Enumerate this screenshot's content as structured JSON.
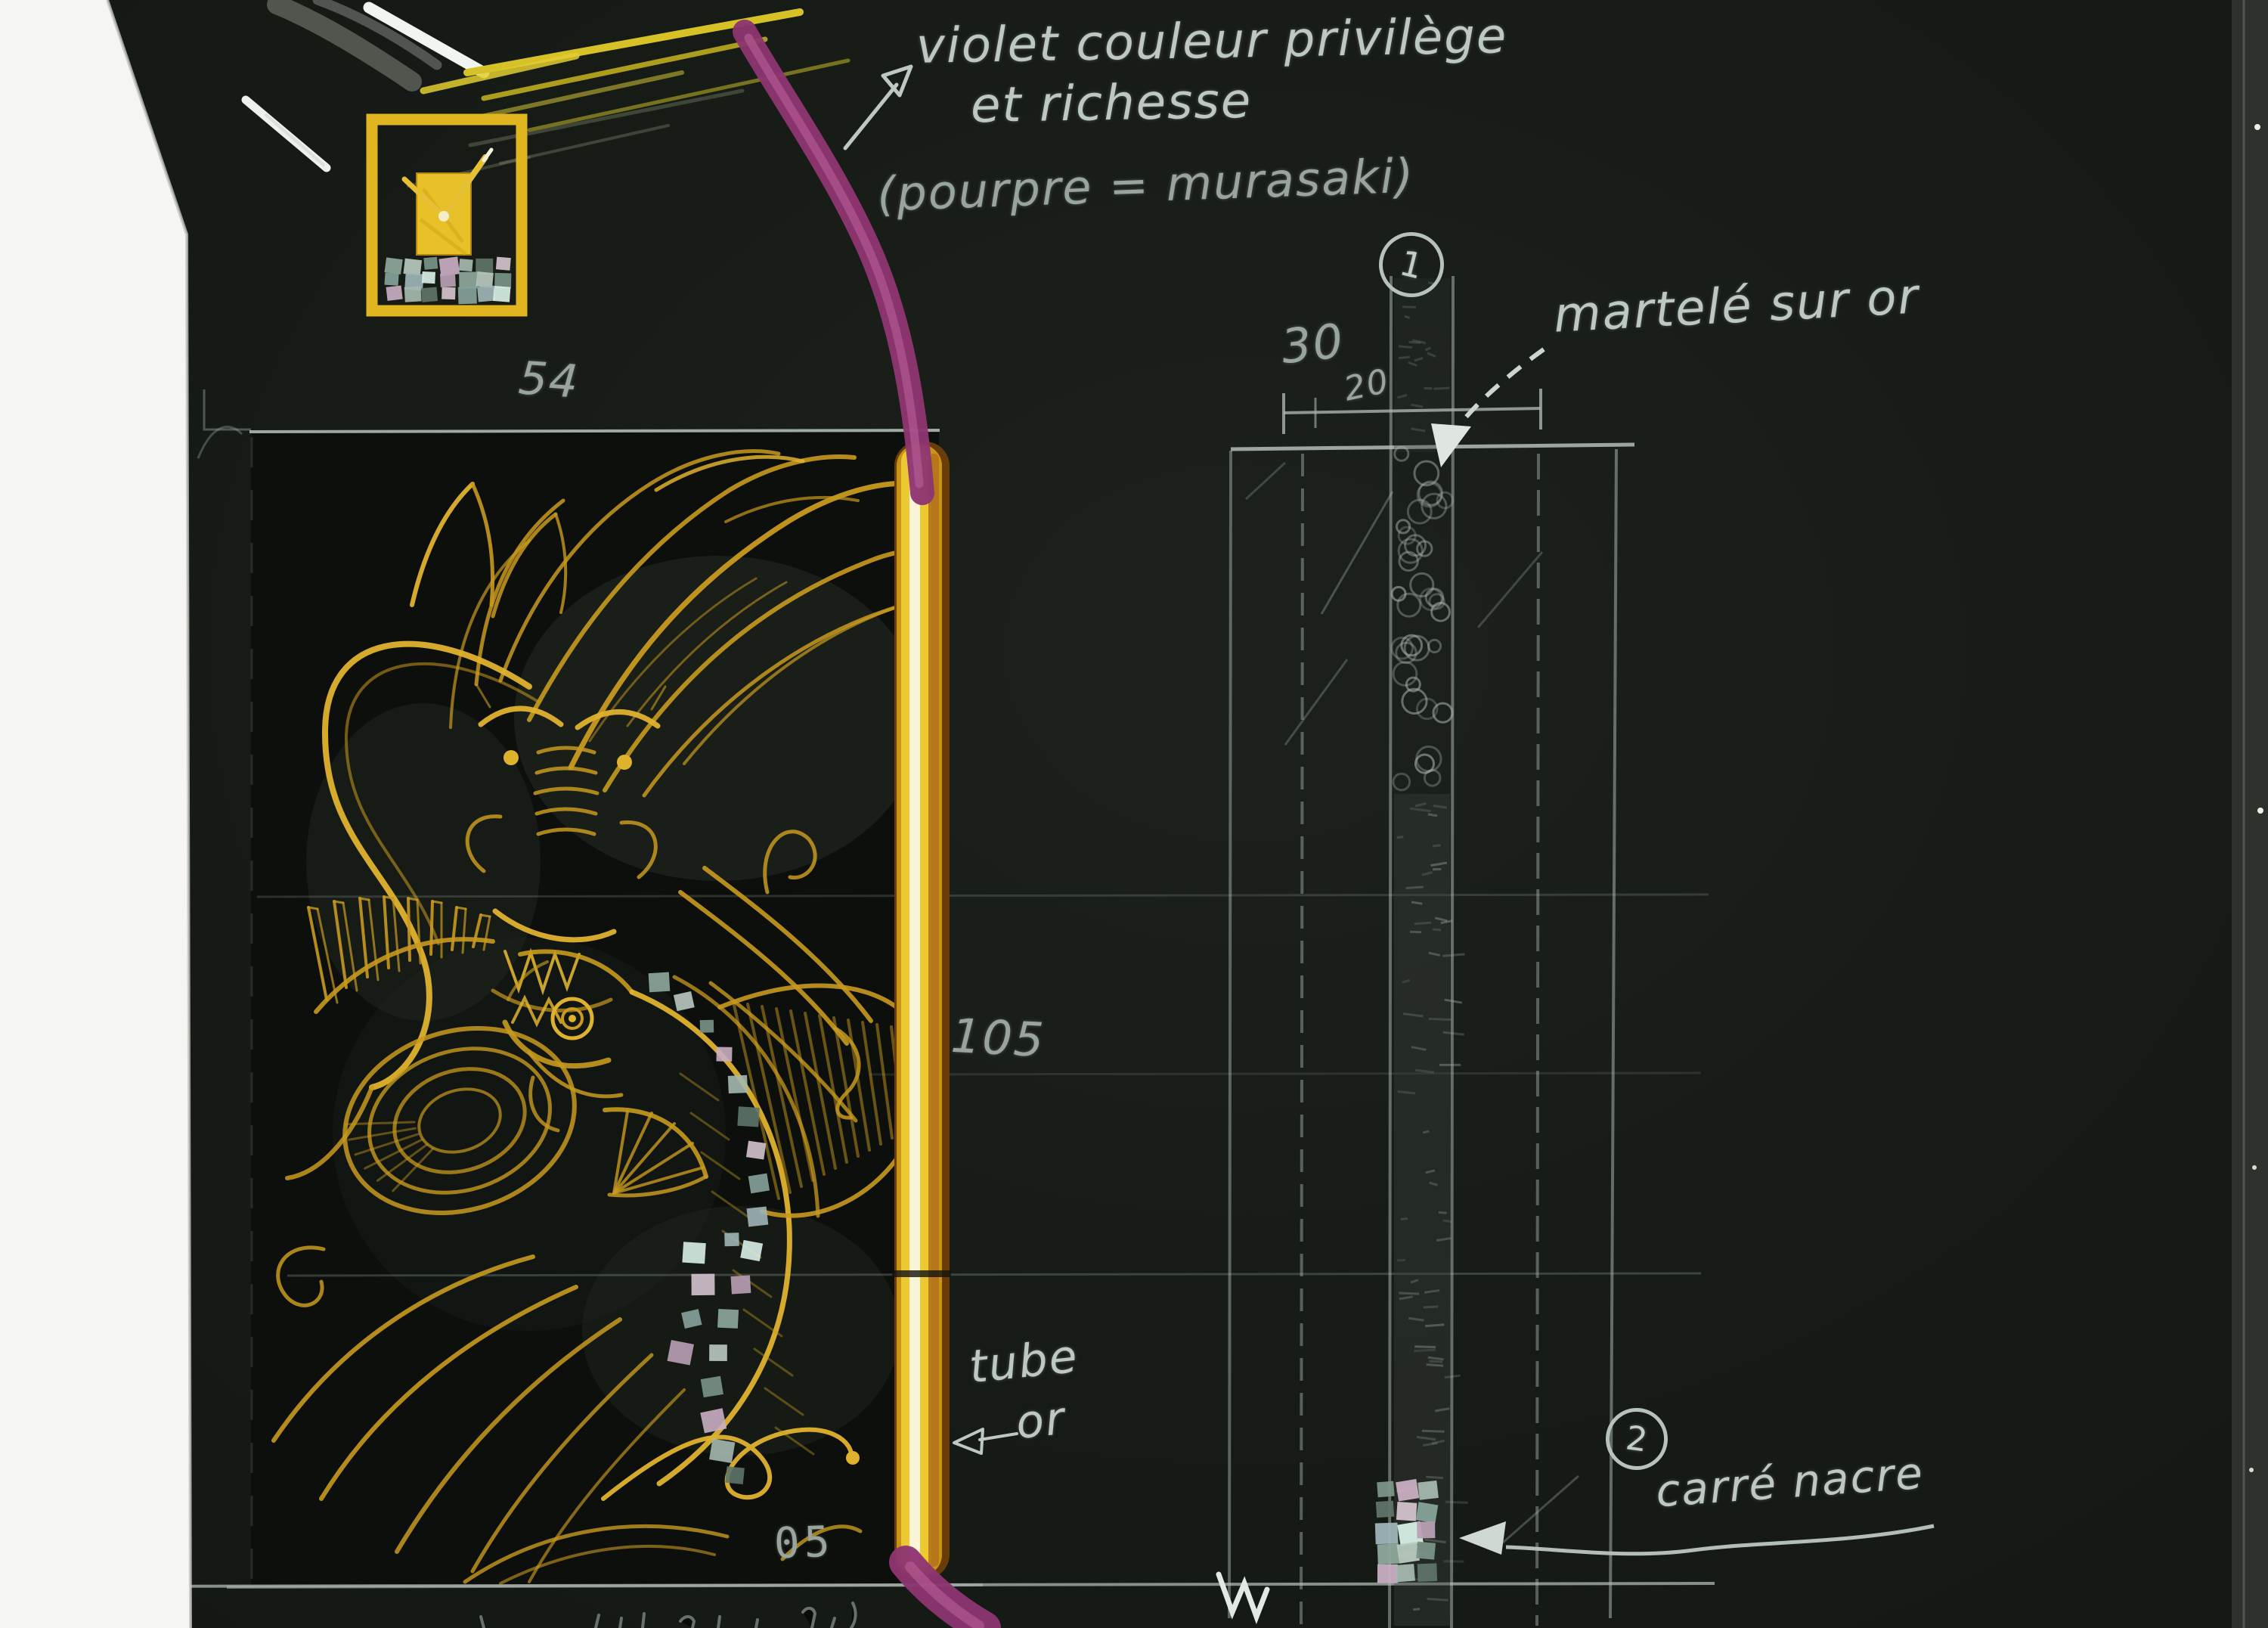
{
  "annotations": {
    "violet_line1": "violet couleur privilège",
    "violet_line2": "et richesse",
    "pourpre": "(pourpre = murasaki)",
    "martele": "martelé sur or",
    "tube_line1": "tube",
    "tube_line2": "or",
    "carre_nacre": "carré nacre",
    "callout_1": "1",
    "callout_2": "2"
  },
  "dimensions": {
    "top_width": "54",
    "band_width": "30",
    "band_offset": "20",
    "tube_length": "105",
    "thickness": "05"
  },
  "colors": {
    "paper": "#171b16",
    "card": "#0c0f0b",
    "gold": "#c89a1e",
    "gold_light": "#f2df63",
    "purple_cord": "#9c3f7c",
    "chalk": "#bdc8c2",
    "nacre_green": "#8fae9e",
    "nacre_pink": "#c9aec2",
    "scan_margin": "#f5f5f2"
  }
}
